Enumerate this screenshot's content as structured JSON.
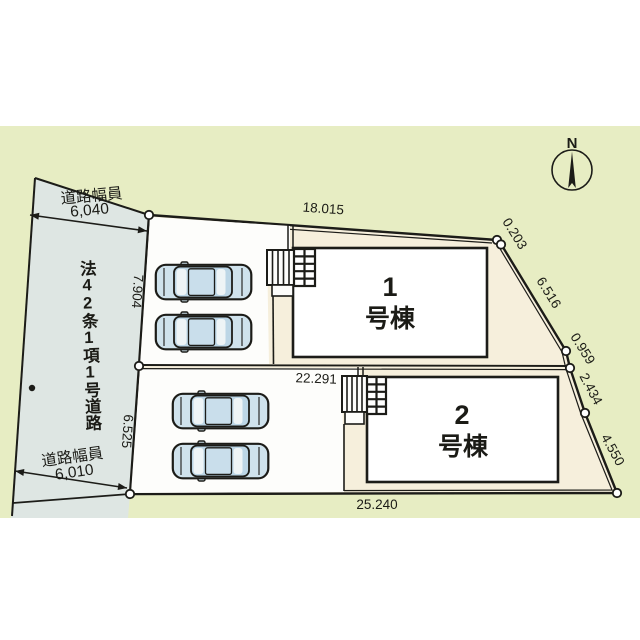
{
  "plan": {
    "title": "site-layout-plan",
    "compass": {
      "north_label": "N"
    },
    "road": {
      "name_vertical": "法42条1項1号道路",
      "top_width_label": "道路幅員",
      "top_width_value": "6,040",
      "bottom_width_label": "道路幅員",
      "bottom_width_value": "6,010"
    },
    "buildings": [
      {
        "number": "1",
        "suffix": "号棟"
      },
      {
        "number": "2",
        "suffix": "号棟"
      }
    ],
    "dimensions": {
      "top_edge": "18.015",
      "right_edge_1": "0.203",
      "right_edge_2": "6.516",
      "right_edge_3": "0.959",
      "right_edge_4": "2.434",
      "right_edge_5": "4.550",
      "left_edge_upper": "7.904",
      "left_edge_lower": "6.525",
      "middle_divider": "22.291",
      "bottom_edge": "25.240"
    },
    "colors": {
      "background_band": "#ffffff",
      "surroundings_green": "#e7edc3",
      "road_gray": "#dee6e3",
      "lot_beige": "#f6efdc",
      "parking_white": "#fdfdfb",
      "line_black": "#1c1c18",
      "car_body_blue": "#cfe2ec",
      "car_glass_blue": "#bcd6e6"
    }
  }
}
